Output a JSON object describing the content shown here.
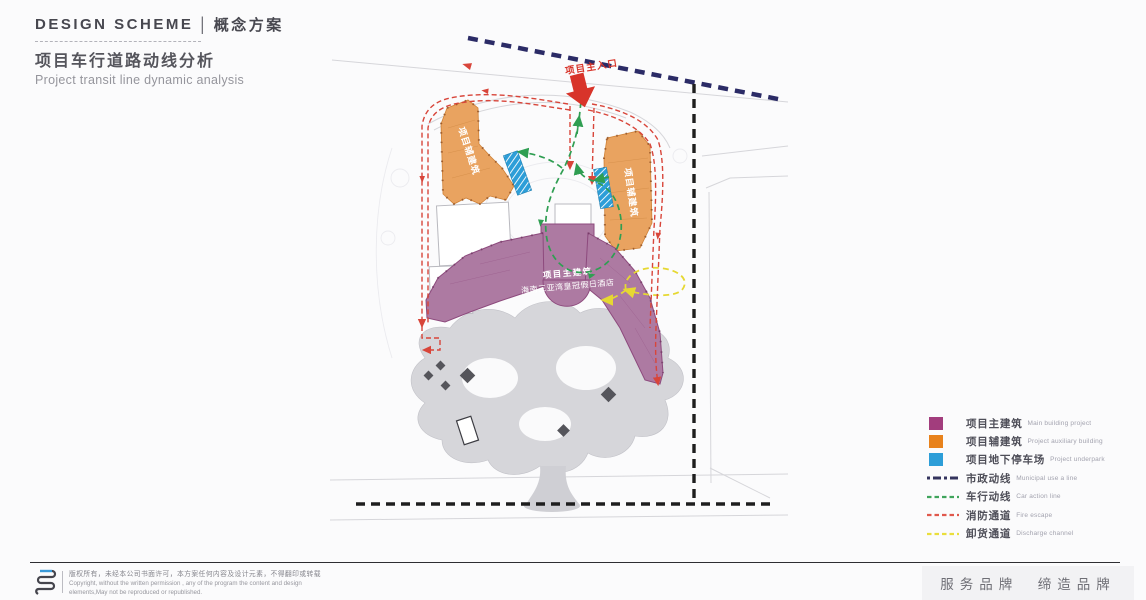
{
  "header": {
    "kicker_en": "DESIGN SCHEME",
    "kicker_sep": "|",
    "kicker_cn": "概念方案",
    "title_cn": "项目车行道路动线分析",
    "title_en": "Project transit line dynamic analysis"
  },
  "map": {
    "entrance_label": "项目主入口",
    "aux_building_label": "项目辅建筑",
    "main_building_line1": "项目主建筑",
    "main_building_line2": "海南三亚湾皇冠假日酒店"
  },
  "legend": {
    "items": [
      {
        "type": "square",
        "color": "#a23d7d",
        "label": "项目主建筑",
        "sublabel": "Main building project"
      },
      {
        "type": "square",
        "color": "#e8821c",
        "label": "项目辅建筑",
        "sublabel": "Project auxiliary building"
      },
      {
        "type": "square",
        "color": "#2d9ed8",
        "label": "项目地下停车场",
        "sublabel": "Project underpark"
      },
      {
        "type": "dashdot",
        "color": "#34345e",
        "label": "市政动线",
        "sublabel": "Municipal use a line"
      },
      {
        "type": "dash",
        "color": "#3fa45c",
        "label": "车行动线",
        "sublabel": "Car action line"
      },
      {
        "type": "dash",
        "color": "#e0584c",
        "label": "消防通道",
        "sublabel": "Fire escape"
      },
      {
        "type": "dash",
        "color": "#eade3c",
        "label": "卸货通道",
        "sublabel": "Discharge channel"
      }
    ]
  },
  "footer": {
    "copyright_cn": "版权所有，未经本公司书面许可，本方案任何内容及设计元素，不得翻印或转载",
    "copyright_en1": "Copyright, without the written permission , any of the program the content and design",
    "copyright_en2": "elements,May not be reproduced or republished.",
    "slogan": "服务品牌　缔造品牌"
  },
  "colors": {
    "main_building": "#a23d7d",
    "aux_building": "#e8821c",
    "underground_parking": "#2d9ed8",
    "municipal_line": "#34345e",
    "car_line": "#3fa45c",
    "fire_line": "#e0584c",
    "discharge_line": "#eade3c",
    "entrance_red": "#d8342a"
  }
}
